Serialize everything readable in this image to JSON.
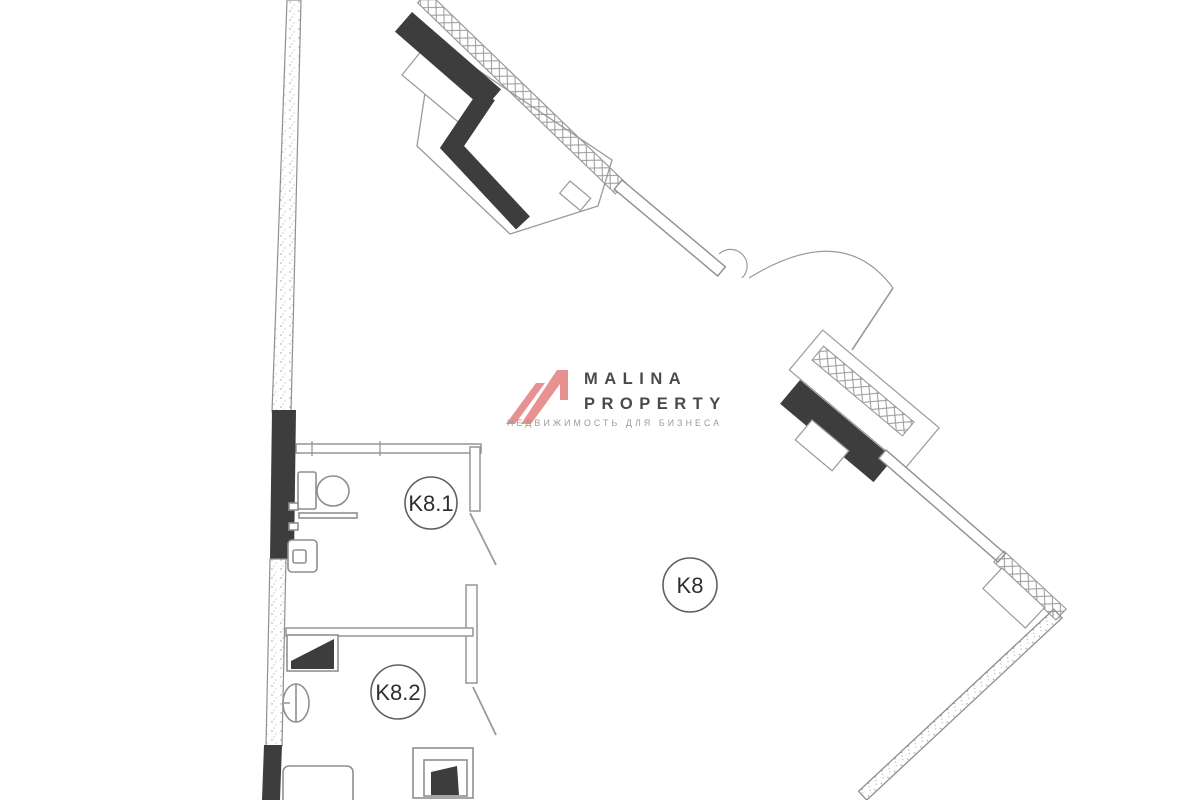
{
  "page": {
    "background_color": "#FFFFFF",
    "description": "Commercial floor plan drawing"
  },
  "logo": {
    "line1": "MALINA",
    "line2": "PROPERTY",
    "tagline": "НЕДВИЖИМОСТЬ ДЛЯ БИЗНЕСА",
    "mark_color": "#E89191",
    "text_color": "#4A4A4A",
    "tagline_color": "#9B9B9B"
  },
  "floor_plan": {
    "type": "architectural-floor-plan",
    "rooms": [
      {
        "label": "K8"
      },
      {
        "label": "K8.1"
      },
      {
        "label": "K8.2"
      }
    ],
    "colors": {
      "wall_line": "#8F8F8F",
      "dark_fill": "#3D3D3D",
      "hatch_line": "#9A9A9A",
      "background": "#FFFFFF"
    }
  }
}
